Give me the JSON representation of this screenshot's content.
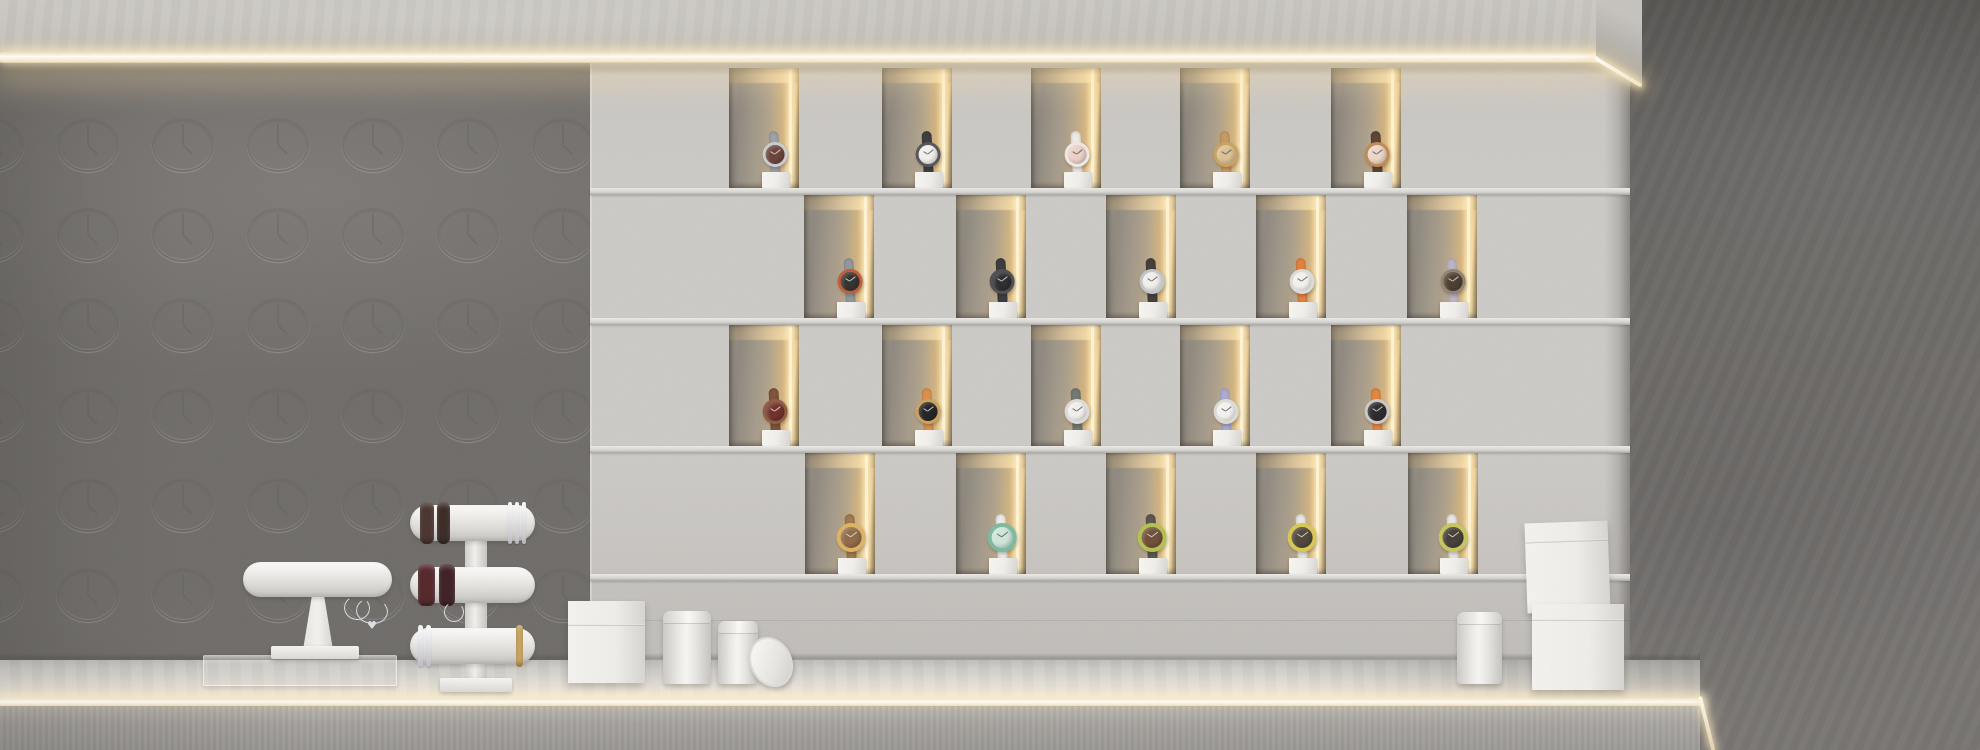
{
  "scene": {
    "description": "Minimalist watch boutique display: concrete fascia with warm LED strip, left concrete wall embossed with clock motifs, central display wall of 20 illuminated watch niches in 4 offset rows, dark concrete wall at right, white counter with bracelet T-bar stands, gift boxes and canisters",
    "width_px": 1980,
    "height_px": 750
  },
  "palette": {
    "fascia": "#c7c4bf",
    "led_warm": "#fff6df",
    "left_wall": "#b4b2af",
    "display_wall": "#cbc8c4",
    "right_wall": "#6e6b68",
    "niche_interior": "#a89e8d",
    "niche_glow": "#e6ca96",
    "counter_top": "#e6e4e0",
    "counter_front": "#a29f9b",
    "pedestal_white": "#f2f1ee",
    "stand_white": "#edebe7"
  },
  "lighting": {
    "ceiling_led": {
      "x": 0,
      "y": 51,
      "length": 1598
    },
    "fascia_end_led": {
      "x": 1595,
      "y": 56
    },
    "counter_led": {
      "x": 0,
      "y": 698,
      "length": 1700
    }
  },
  "wall_pattern": {
    "name": "embossed-clock-motif",
    "cols": [
      -7,
      88,
      183,
      278,
      373,
      468,
      563
    ],
    "rows": [
      145,
      235,
      325,
      415,
      505,
      595
    ],
    "clock_w": 62,
    "clock_h": 54,
    "hour_hand_angle_deg": -45
  },
  "display_wall": {
    "x": 590,
    "width": 1040,
    "top": 63,
    "niche_width": 70,
    "rows": [
      {
        "label": "row-1",
        "top": 68,
        "height": 122,
        "watch_center_y": 155,
        "niches": [
          {
            "x": 729,
            "watch_x": 776,
            "watch": {
              "desc": "copper-brown dial, steel case, grey metal strap",
              "dial": "#6a4238",
              "ring": "#c9ccd0",
              "strap": "#9ba1a7"
            }
          },
          {
            "x": 882,
            "watch_x": 929,
            "watch": {
              "desc": "white dial, black case, black strap",
              "dial": "#f2f0ec",
              "ring": "#55555a",
              "strap": "#3c3b3d"
            }
          },
          {
            "x": 1031,
            "watch_x": 1078,
            "watch": {
              "desc": "rose-pink dial, white strap",
              "dial": "#ecd0c8",
              "ring": "#efe9e4",
              "strap": "#f0ebe6"
            }
          },
          {
            "x": 1180,
            "watch_x": 1227,
            "watch": {
              "desc": "champagne gold dial, tan leather strap",
              "dial": "#dcc094",
              "ring": "#c9a25c",
              "strap": "#c79a62"
            }
          },
          {
            "x": 1331,
            "watch_x": 1378,
            "watch": {
              "desc": "pale rose dial, gold case, dark brown strap",
              "dial": "#ecd8ca",
              "ring": "#c08a52",
              "strap": "#5c4234"
            }
          }
        ]
      },
      {
        "label": "row-2",
        "top": 195,
        "height": 125,
        "watch_center_y": 282,
        "niches": [
          {
            "x": 804,
            "watch_x": 851,
            "watch": {
              "desc": "black dial, red-orange bezel, steel strap",
              "dial": "#33302d",
              "ring": "#c25c38",
              "strap": "#93979b"
            }
          },
          {
            "x": 956,
            "watch_x": 1003,
            "watch": {
              "desc": "all-black watch",
              "dial": "#2c2b2e",
              "ring": "#504e50",
              "strap": "#3b3a3c"
            }
          },
          {
            "x": 1106,
            "watch_x": 1153,
            "watch": {
              "desc": "white dial, steel case, dark brown strap",
              "dial": "#f2f0ec",
              "ring": "#c2c5c9",
              "strap": "#443e3a"
            }
          },
          {
            "x": 1256,
            "watch_x": 1303,
            "watch": {
              "desc": "white dial, orange strap",
              "dial": "#f4f2ee",
              "ring": "#dddbd7",
              "strap": "#e2803e"
            }
          },
          {
            "x": 1407,
            "watch_x": 1454,
            "watch": {
              "desc": "dark brown dial, lavender-grey strap",
              "dial": "#4c3c30",
              "ring": "#93836e",
              "strap": "#bcb4c6"
            }
          }
        ]
      },
      {
        "label": "row-3",
        "top": 325,
        "height": 123,
        "watch_center_y": 412,
        "niches": [
          {
            "x": 729,
            "watch_x": 776,
            "watch": {
              "desc": "burgundy dial, wood bezel, brown strap",
              "dial": "#702f28",
              "ring": "#8f5d40",
              "strap": "#7d5338"
            }
          },
          {
            "x": 882,
            "watch_x": 929,
            "watch": {
              "desc": "black dial, gold case, tan-orange strap",
              "dial": "#232225",
              "ring": "#cda25c",
              "strap": "#db8f4e"
            }
          },
          {
            "x": 1031,
            "watch_x": 1078,
            "watch": {
              "desc": "white dial, grey-green strap",
              "dial": "#f2f0ec",
              "ring": "#dddbd7",
              "strap": "#737870"
            }
          },
          {
            "x": 1180,
            "watch_x": 1227,
            "watch": {
              "desc": "white dial, lilac strap",
              "dial": "#f4f2ee",
              "ring": "#dddbd7",
              "strap": "#adaace"
            }
          },
          {
            "x": 1331,
            "watch_x": 1378,
            "watch": {
              "desc": "black dial, silver case, orange strap",
              "dial": "#2a292c",
              "ring": "#ccc9c5",
              "strap": "#e5863e"
            }
          }
        ]
      },
      {
        "label": "row-4",
        "top": 453,
        "height": 123,
        "watch_center_y": 538,
        "niches": [
          {
            "x": 805,
            "watch_x": 852,
            "watch": {
              "desc": "wooden bangle watch with wide gold ring bezel",
              "dial": "#8f6a46",
              "ring": "#deb262",
              "strap": "#a0794e"
            }
          },
          {
            "x": 956,
            "watch_x": 1003,
            "watch": {
              "desc": "teal patterned dial, white strap",
              "dial": "#cfe6da",
              "ring": "#7cbaa0",
              "strap": "#edece8"
            }
          },
          {
            "x": 1106,
            "watch_x": 1153,
            "watch": {
              "desc": "brown dial, yellow-green rim, dark grey strap",
              "dial": "#6f4e36",
              "ring": "#b5c050",
              "strap": "#5a554f"
            }
          },
          {
            "x": 1256,
            "watch_x": 1303,
            "watch": {
              "desc": "dark dial, yellow rim, white strap",
              "dial": "#4e4639",
              "ring": "#d8c850",
              "strap": "#eae8e4"
            }
          },
          {
            "x": 1408,
            "watch_x": 1454,
            "watch": {
              "desc": "dark dial, yellow-green rim, white strap",
              "dial": "#443e36",
              "ring": "#c6c65c",
              "strap": "#eae8e4"
            }
          }
        ]
      }
    ]
  },
  "counter": {
    "top_y": 660,
    "led_y": 698,
    "front_top": 706,
    "right_end_x": 1700
  },
  "stands": {
    "single_tbar": {
      "desc": "white single-tier bracelet T-bar stand on clear acrylic tray",
      "tray": {
        "x": 203,
        "y": 655,
        "w": 194,
        "h": 31
      },
      "bar": {
        "x": 243,
        "y": 562,
        "w": 149,
        "h": 35
      },
      "support": {
        "x": 303,
        "y": 595,
        "w": 30,
        "h": 55
      },
      "base": {
        "x": 271,
        "y": 646,
        "w": 88,
        "h": 13
      },
      "bracelets": [
        {
          "dx": 11,
          "w": 15,
          "color": "#4e3630",
          "type": "band"
        },
        {
          "dx": 29,
          "w": 14,
          "color": "#41302b",
          "type": "band"
        },
        {
          "dx": 48,
          "w": 5,
          "color": "#e9e9ec",
          "type": "wire"
        },
        {
          "dx": 56,
          "w": 4,
          "color": "#dcdce0",
          "type": "wire"
        },
        {
          "dx": 99,
          "w": 4,
          "color": "#e6e6ea",
          "type": "wire"
        },
        {
          "dx": 107,
          "w": 4,
          "color": "#d8d8dc",
          "type": "wire"
        },
        {
          "dx": 115,
          "w": 4,
          "color": "#e6e6ea",
          "type": "wire"
        }
      ],
      "hanging": [
        {
          "x": 344,
          "y": 596,
          "w": 26,
          "h": 24,
          "heart": false
        },
        {
          "x": 356,
          "y": 598,
          "w": 32,
          "h": 26,
          "heart": true
        }
      ]
    },
    "triple_tbar": {
      "desc": "white three-tier bracelet T-bar stand",
      "column": {
        "x": 465,
        "y": 505,
        "w": 22,
        "h": 180
      },
      "base": {
        "x": 440,
        "y": 678,
        "w": 72,
        "h": 14
      },
      "bars": [
        {
          "x": 410,
          "y": 505,
          "w": 125,
          "h": 36,
          "bracelets": [
            {
              "dx": 10,
              "w": 14,
              "color": "#4a3430",
              "type": "band"
            },
            {
              "dx": 27,
              "w": 13,
              "color": "#3b2a26",
              "type": "band"
            },
            {
              "dx": 98,
              "w": 4,
              "color": "#e6e6ea",
              "type": "wire"
            },
            {
              "dx": 105,
              "w": 4,
              "color": "#dcdce0",
              "type": "wire"
            },
            {
              "dx": 112,
              "w": 4,
              "color": "#e6e6ea",
              "type": "wire"
            }
          ]
        },
        {
          "x": 410,
          "y": 567,
          "w": 125,
          "h": 36,
          "bracelets": [
            {
              "dx": 8,
              "w": 17,
              "color": "#54262a",
              "type": "band"
            },
            {
              "dx": 29,
              "w": 16,
              "color": "#3f2024",
              "type": "band"
            }
          ]
        },
        {
          "x": 410,
          "y": 628,
          "w": 125,
          "h": 36,
          "bracelets": [
            {
              "dx": 8,
              "w": 5,
              "color": "#e8e8ec",
              "type": "wire"
            },
            {
              "dx": 16,
              "w": 5,
              "color": "#dcdce0",
              "type": "wire"
            },
            {
              "dx": 106,
              "w": 7,
              "color": "#cfa75c",
              "type": "band"
            }
          ]
        }
      ],
      "hanging": [
        {
          "x": 444,
          "y": 602,
          "w": 20,
          "h": 20,
          "heart": false
        }
      ]
    }
  },
  "props": {
    "left_cube_box": {
      "desc": "white gift box with lid",
      "x": 568,
      "y": 601,
      "w": 77,
      "h": 82,
      "seam_y": 23
    },
    "center_canisters": [
      {
        "desc": "white canister with lid",
        "x": 663,
        "y": 611,
        "w": 48,
        "h": 73
      },
      {
        "desc": "white canister open",
        "x": 718,
        "y": 621,
        "w": 40,
        "h": 63
      }
    ],
    "leaning_lid": {
      "desc": "canister lid leaning against canister",
      "x": 750,
      "y": 636,
      "w": 42,
      "h": 52
    },
    "right_canister": {
      "desc": "white canister with lid",
      "x": 1457,
      "y": 612,
      "w": 45,
      "h": 72
    },
    "stacked_boxes": [
      {
        "desc": "upper white gift box, slightly rotated",
        "x": 1526,
        "y": 522,
        "w": 83,
        "h": 90,
        "seam_y": 18,
        "rotation": -2
      },
      {
        "desc": "lower white gift box",
        "x": 1532,
        "y": 604,
        "w": 92,
        "h": 86,
        "seam_y": 15,
        "rotation": 0
      }
    ]
  }
}
